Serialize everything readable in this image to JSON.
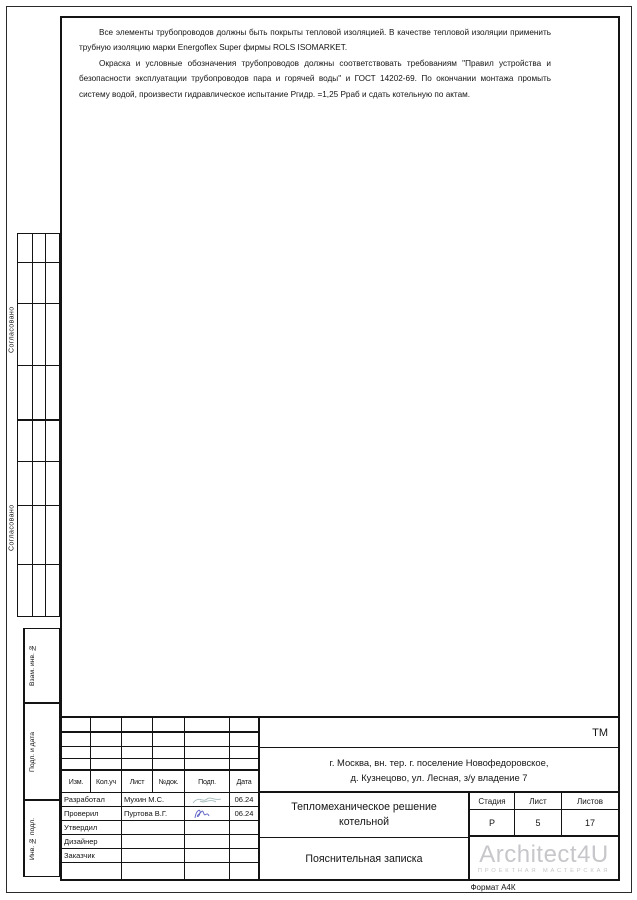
{
  "page": {
    "format_label": "Формат А4К"
  },
  "notes": {
    "paragraph1": "Все элементы трубопроводов должны быть покрыты тепловой изоляцией. В качестве тепловой изоляции применить трубную изоляцию марки Energoflex Super фирмы ROLS ISOMARKET.",
    "paragraph2": "Окраска и условные обозначения трубопроводов должны соответствовать требованиям \"Правил устройства и безопасности эксплуатации трубопроводов пара и горячей воды\" и ГОСТ 14202-69. По окончании монтажа промыть систему водой, произвести гидравлическое испытание Ргидр. =1,25 Рраб и сдать котельную по актам."
  },
  "side_labels": {
    "agreed1": "Согласовано",
    "agreed2": "Согласовано",
    "vzam": "Взам. инв. №",
    "podp": "Подп. и дата",
    "inv": "Инв. № подл."
  },
  "title_block": {
    "code": "ТМ",
    "address_line1": "г. Москва, вн. тер. г. поселение Новофедоровское,",
    "address_line2": "д. Кузнецово, ул. Лесная, з/у владение 7",
    "title_line1": "Тепломеханическое решение",
    "title_line2": "котельной",
    "doc_type": "Пояснительная записка",
    "columns": [
      "Изм.",
      "Кол.уч",
      "Лист",
      "№док.",
      "Подп.",
      "Дата"
    ],
    "rows": [
      {
        "role": "Разработал",
        "name": "Мухин М.С.",
        "date": "06.24"
      },
      {
        "role": "Проверил",
        "name": "Пуртова В.Г.",
        "date": "06.24"
      },
      {
        "role": "Утвердил",
        "name": "",
        "date": ""
      },
      {
        "role": "Дизайнер",
        "name": "",
        "date": ""
      },
      {
        "role": "Заказчик",
        "name": "",
        "date": ""
      }
    ],
    "stage_header": [
      "Стадия",
      "Лист",
      "Листов"
    ],
    "stage": "Р",
    "sheet": "5",
    "sheets": "17",
    "logo": {
      "name": "Architect4U",
      "subtitle": "ПРОЕКТНАЯ МАСТЕРСКАЯ",
      "color": "#c7c7cb"
    }
  },
  "colors": {
    "sig1": "#a6bcbd",
    "sig2": "#5b61c4",
    "line": "#141414"
  }
}
